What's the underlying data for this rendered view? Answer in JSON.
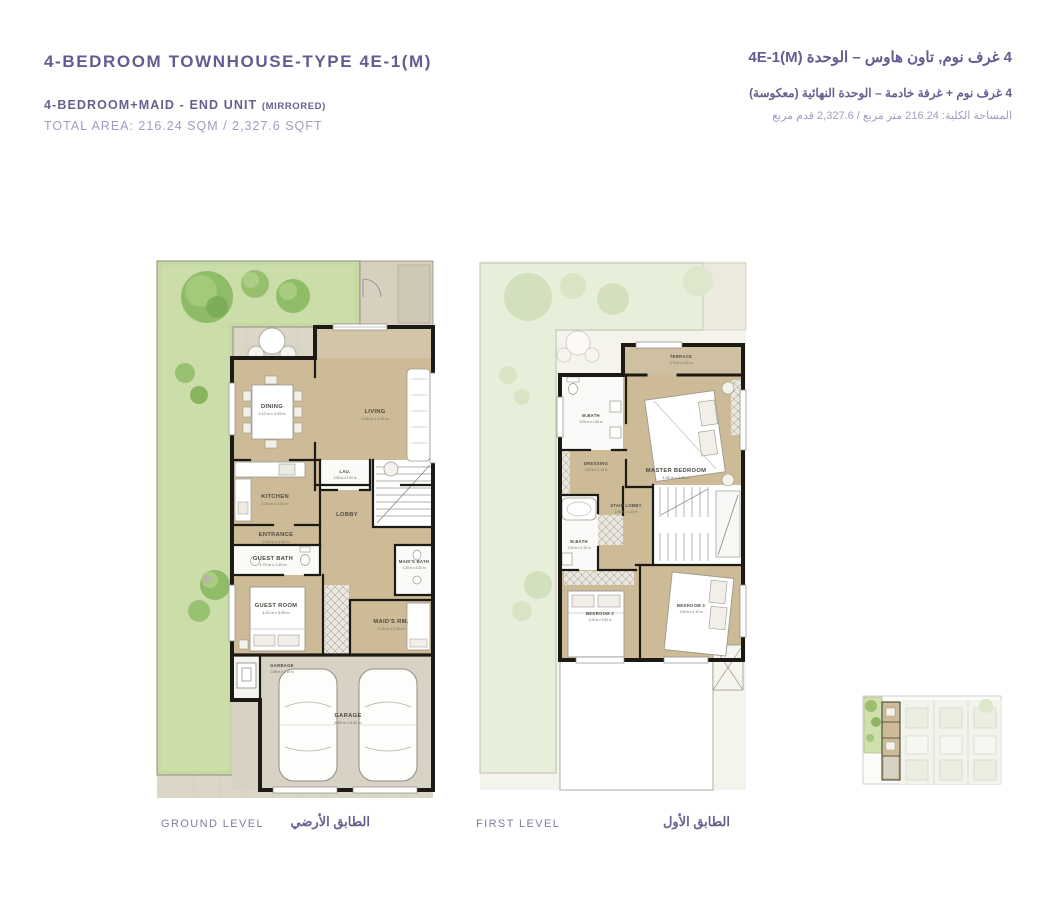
{
  "header_left": {
    "title": "4-BEDROOM TOWNHOUSE-TYPE 4E-1(M)",
    "subtitle": "4-BEDROOM+MAID - END UNIT",
    "subtitle_note": "(MIRRORED)",
    "total_area": "TOTAL AREA: 216.24 SQM / 2,327.6 SQFT"
  },
  "header_right": {
    "title_ar": "4 غرف نوم, تاون هاوس – الوحدة 4E-1(M)",
    "subtitle_ar": "4 غرف نوم + غرفة خادمة – الوحدة النهائية (معكوسة)",
    "total_area_ar": "المساحة الكلية: 216.24 متر مربع / 2,327.6 قدم مربع"
  },
  "colors": {
    "accent_purple": "#665a92",
    "accent_light_purple": "#a49bc0",
    "wall_black": "#1d1a15",
    "room_tan": "#cdbb97",
    "garden_green": "#c6d9a2",
    "paving_beige": "#dcd6c7",
    "faded_garden": "#e7eeda"
  },
  "ground_level": {
    "label_en": "GROUND LEVEL",
    "label_ar": "الطابق الأرضي",
    "rooms": [
      {
        "name": "DINING",
        "dims": "3.10 m x 2.05 m"
      },
      {
        "name": "LIVING",
        "dims": "3.55 m x 4.25 m"
      },
      {
        "name": "KITCHEN",
        "dims": "2.55 m x 3.00 m"
      },
      {
        "name": "LAU.",
        "dims": "2.05 m x 1.00 m"
      },
      {
        "name": "LOBBY",
        "dims": ""
      },
      {
        "name": "ENTRANCE",
        "dims": "2.05 m x 1.10 m"
      },
      {
        "name": "GUEST BATH",
        "dims": "2.70 m x 1.40 m"
      },
      {
        "name": "MAID'S BATH",
        "dims": "1.20 m x 2.00 m"
      },
      {
        "name": "GUEST ROOM",
        "dims": "4.20 m x 3.05 m"
      },
      {
        "name": "MAID'S RM.",
        "dims": "2.05 m x 2.00 m"
      },
      {
        "name": "GARBAGE",
        "dims": "0.65 m x 1.10 m"
      },
      {
        "name": "GARAGE",
        "dims": "5.55 m x 5.80 m"
      }
    ]
  },
  "first_level": {
    "label_en": "FIRST LEVEL",
    "label_ar": "الطابق الأول",
    "rooms": [
      {
        "name": "TERRACE",
        "dims": "3.70 m x 1.50 m"
      },
      {
        "name": "M.BATH",
        "dims": "3.20 m x 1.60 m"
      },
      {
        "name": "MASTER BEDROOM",
        "dims": "4.35 m x 3.65 m"
      },
      {
        "name": "DRESSING",
        "dims": "2.00 m x 1.15 m"
      },
      {
        "name": "STAIR LOBBY",
        "dims": "2.55 m x 1.20 m"
      },
      {
        "name": "M.BATH",
        "dims": "2.00 m x 2.15 m"
      },
      {
        "name": "BEDROOM 2",
        "dims": "3.20 m x 3.60 m"
      },
      {
        "name": "BEDROOM 3",
        "dims": "3.55 m x 4.10 m"
      }
    ]
  }
}
